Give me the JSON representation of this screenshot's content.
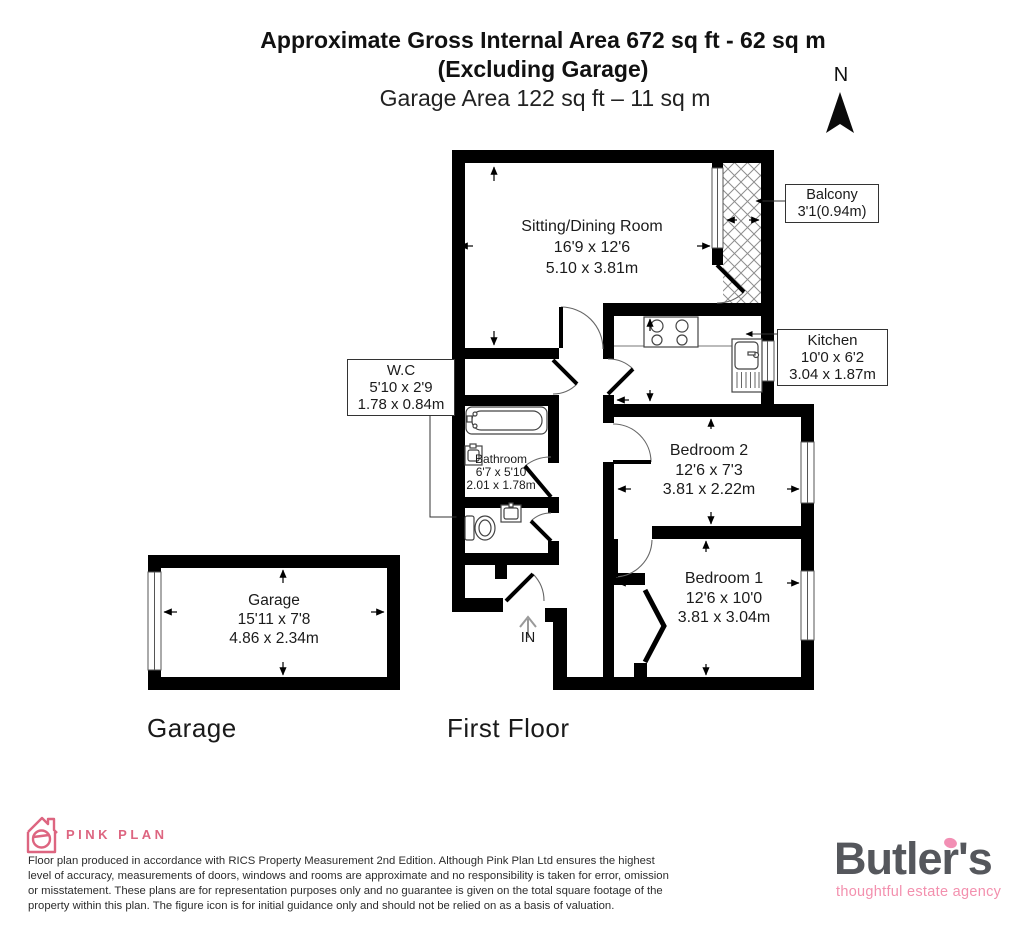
{
  "header": {
    "title_line1": "Approximate Gross Internal Area 672 sq ft - 62 sq m",
    "title_line2": "(Excluding Garage)",
    "title_line3": "Garage Area 122 sq ft – 11 sq m",
    "north_label": "N"
  },
  "rooms": {
    "sitting": {
      "name": "Sitting/Dining Room",
      "imperial": "16'9 x 12'6",
      "metric": "5.10 x 3.81m"
    },
    "balcony": {
      "name": "Balcony",
      "dims": "3'1(0.94m)"
    },
    "kitchen": {
      "name": "Kitchen",
      "imperial": "10'0 x 6'2",
      "metric": "3.04 x 1.87m"
    },
    "wc": {
      "name": "W.C",
      "imperial": "5'10 x 2'9",
      "metric": "1.78 x 0.84m"
    },
    "bathroom": {
      "name": "Bathroom",
      "imperial": "6'7 x 5'10",
      "metric": "2.01 x 1.78m"
    },
    "bedroom2": {
      "name": "Bedroom 2",
      "imperial": "12'6 x 7'3",
      "metric": "3.81 x 2.22m"
    },
    "bedroom1": {
      "name": "Bedroom 1",
      "imperial": "12'6 x 10'0",
      "metric": "3.81 x 3.04m"
    },
    "garage": {
      "name": "Garage",
      "imperial": "15'11 x 7'8",
      "metric": "4.86 x 2.34m"
    }
  },
  "plan": {
    "in_label": "IN",
    "garage_floor_label": "Garage",
    "first_floor_label": "First Floor"
  },
  "footer": {
    "brand": "PINK PLAN",
    "disclaimer_lines": [
      "Floor plan produced in accordance with RICS Property Measurement 2nd Edition. Although Pink Plan Ltd ensures the highest",
      "level of accuracy, measurements of doors, windows and rooms are approximate and no responsibility is taken for error, omission",
      "or misstatement. These plans are for representation purposes only and no guarantee is given on the total square footage of the",
      "property within this plan. The figure icon is for initial guidance only and should not be relied on as a basis of valuation."
    ],
    "agency_name": "Butler's",
    "agency_tagline": "thoughtful estate agency"
  },
  "colors": {
    "wall_black": "#000000",
    "pinkplan_pink": "#dd6580",
    "butlers_gray": "#55575c",
    "butlers_pink": "#f390ae"
  }
}
